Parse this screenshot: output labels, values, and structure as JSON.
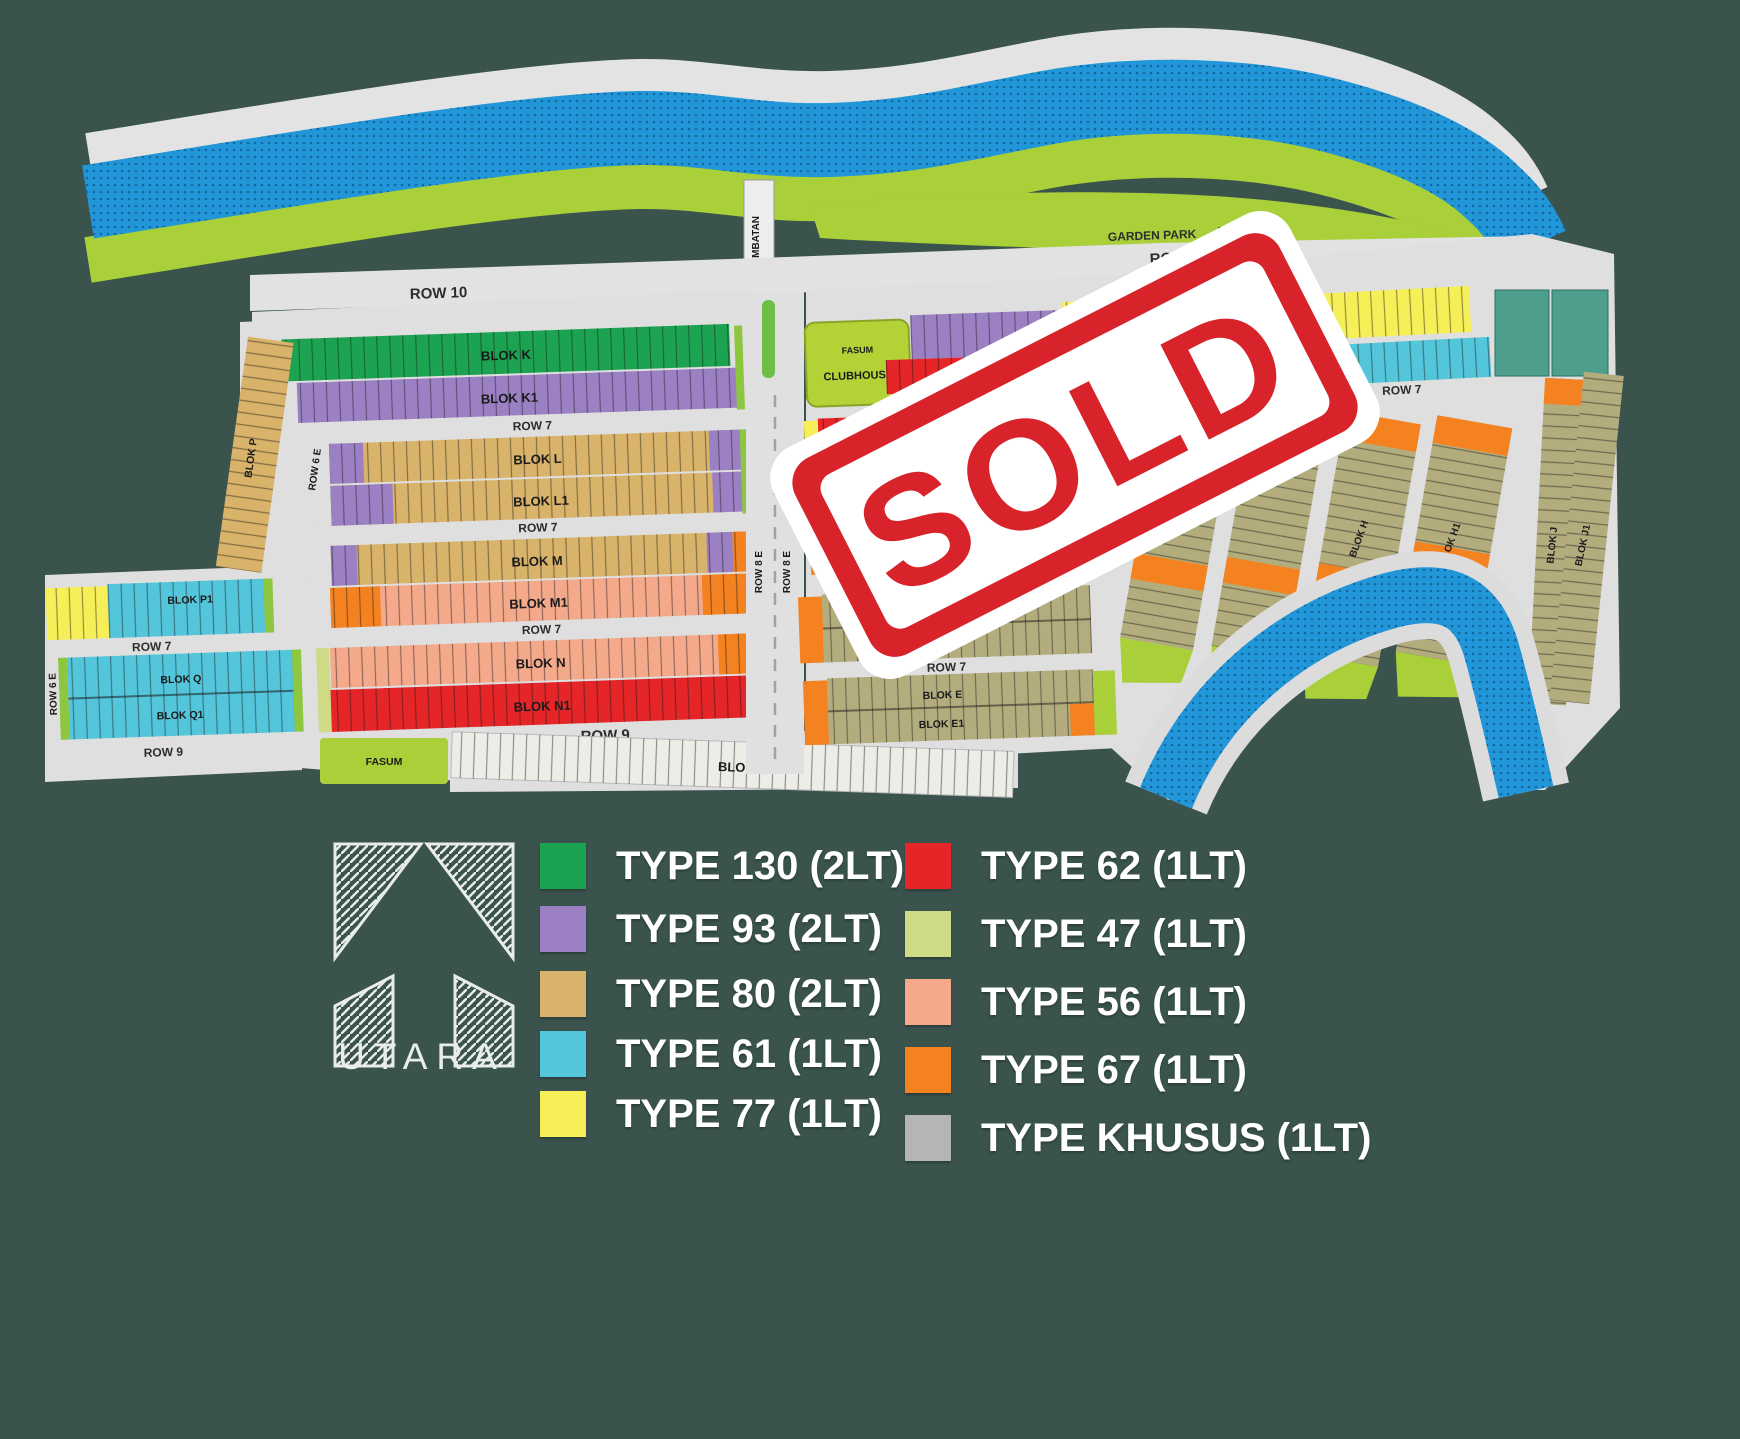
{
  "map": {
    "sold_stamp": "SOLD",
    "landmarks": {
      "bridge": "JEMBATAN",
      "garden_park": "GARDEN PARK",
      "garden_park_fasum": "FASUM",
      "clubhouse_fasum": "FASUM",
      "clubhouse": "CLUBHOUSE",
      "fasum_south": "FASUM"
    },
    "roads": {
      "row10_left": "ROW 10",
      "row10_right": "ROW 10",
      "row7_a": "ROW 7",
      "row7_b": "ROW 7",
      "row7_c": "ROW 7",
      "row7_left_lower": "ROW 7",
      "row7_right_upper": "ROW 7",
      "row7_right_mid": "ROW 7",
      "row7_far_right": "ROW 7",
      "row9_left": "ROW 9",
      "row9_main": "ROW 9",
      "row8e_a": "ROW 8 E",
      "row8e_b": "ROW 8 E",
      "row6e_a": "ROW 6 E",
      "row6e_b": "ROW 6 E"
    },
    "blocks": {
      "k": "BLOK K",
      "k1": "BLOK K1",
      "l": "BLOK L",
      "l1": "BLOK L1",
      "m": "BLOK M",
      "m1": "BLOK M1",
      "n": "BLOK N",
      "n1": "BLOK N1",
      "o": "BLOK O",
      "p": "BLOK P",
      "p1": "BLOK P1",
      "q": "BLOK Q",
      "q1": "BLOK Q1",
      "a": "BLOK A",
      "b": "BLOK B",
      "b1": "BLOK B1",
      "d": "BLOK D",
      "d1": "BLOK D1",
      "e": "BLOK E",
      "e1": "BLOK E1",
      "h": "BLOK H",
      "h1": "BLOK H1",
      "j": "BLOK J",
      "j1": "BLOK J1"
    }
  },
  "legend": {
    "items": [
      {
        "label": "TYPE 130 (2LT)",
        "color": "#1CA351"
      },
      {
        "label": "TYPE 93 (2LT)",
        "color": "#9C80C4"
      },
      {
        "label": "TYPE 80 (2LT)",
        "color": "#D9B369"
      },
      {
        "label": "TYPE 61 (1LT)",
        "color": "#54C6DB"
      },
      {
        "label": "TYPE 77 (1LT)",
        "color": "#F7EF57"
      },
      {
        "label": "TYPE 62 (1LT)",
        "color": "#E52528"
      },
      {
        "label": "TYPE 47 (1LT)",
        "color": "#CEDA84"
      },
      {
        "label": "TYPE 56 (1LT)",
        "color": "#F4A98B"
      },
      {
        "label": "TYPE 67 (1LT)",
        "color": "#F58220"
      },
      {
        "label": "TYPE KHUSUS (1LT)",
        "color": "#B5B5B5"
      }
    ]
  },
  "north_arrow": {
    "label": "UTARA"
  },
  "colors": {
    "background": "#3A534D",
    "water": "#2196D8",
    "grass": "#A9CF39",
    "road": "#E0E0E0",
    "stamp_red": "#D8232A",
    "olive_lots": "#B3AD7E",
    "teal_lots": "#4E9E8E"
  }
}
